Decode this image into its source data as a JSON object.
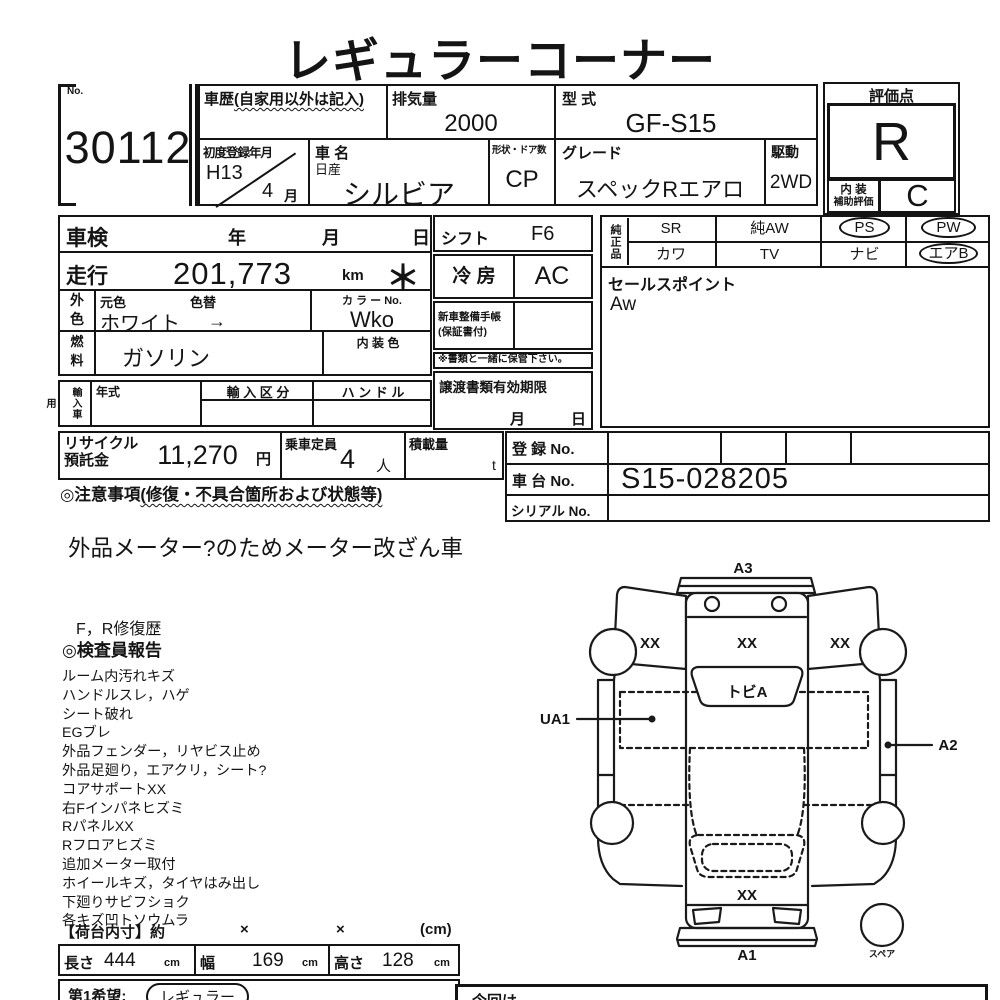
{
  "title": "レギュラーコーナー",
  "lot": {
    "no_label": "No.",
    "no": "30112"
  },
  "header": {
    "history": {
      "label": "車歴",
      "note": "(自家用以外は記入)"
    },
    "displacement": {
      "label": "排気量",
      "value": "2000"
    },
    "model_code": {
      "label": "型  式",
      "value": "GF-S15"
    },
    "first_reg": {
      "label": "初度登録年月",
      "year": "H13",
      "month": "4",
      "month_unit": "月"
    },
    "car_name": {
      "label": "車  名",
      "maker": "日産",
      "value": "シルビア"
    },
    "body_doors": {
      "label": "形状・ドア数",
      "value": "CP"
    },
    "grade": {
      "label": "グレード",
      "value": "スペックRエアロ"
    },
    "drive": {
      "label": "駆動",
      "value": "2WD"
    },
    "score": {
      "label": "評価点",
      "value": "R",
      "interior_label_1": "内 装",
      "interior_label_2": "補助評価",
      "interior_value": "C"
    }
  },
  "left_table": {
    "shaken": {
      "label": "車検",
      "year": "年",
      "month": "月",
      "day": "日"
    },
    "mileage": {
      "label": "走行",
      "value": "201,773",
      "unit": "km",
      "asterisk": "＊"
    },
    "color": {
      "header_1": "外",
      "header_2": "色",
      "base_label": "元色",
      "change_label": "色替",
      "value": "ホワイト",
      "arrow": "→",
      "color_no_label": "カ ラ ー No.",
      "color_no": "Wko"
    },
    "fuel": {
      "header_1": "燃",
      "header_2": "料",
      "value": "ガソリン",
      "interior_color_label": "内 装 色"
    },
    "import": {
      "header": "輸入車用",
      "year_label": "年式",
      "class_label": "輸 入 区 分",
      "handle_label": "ハ ン ド ル"
    }
  },
  "mid": {
    "shift": {
      "label": "シフト",
      "value": "F6"
    },
    "ac": {
      "label": "冷  房",
      "value": "AC"
    },
    "service_book": {
      "label": "新車整備手帳",
      "sub": "(保証書付)"
    },
    "keep_note": "※書類と一緒に保管下さい。",
    "transfer_docs": {
      "label": "譲渡書類有効期限",
      "month": "月",
      "day": "日"
    }
  },
  "oem": {
    "header": "純正品",
    "row1": [
      {
        "label": "SR",
        "circled": false
      },
      {
        "label": "純AW",
        "circled": false
      },
      {
        "label": "PS",
        "circled": true
      },
      {
        "label": "PW",
        "circled": true
      }
    ],
    "row2": [
      {
        "label": "カワ",
        "circled": false
      },
      {
        "label": "TV",
        "circled": false
      },
      {
        "label": "ナビ",
        "circled": false
      },
      {
        "label": "エアB",
        "circled": true
      }
    ]
  },
  "sales_point": {
    "label": "セールスポイント",
    "value": "Aw"
  },
  "recycle": {
    "label1": "リサイクル",
    "label2": "預託金",
    "value": "11,270",
    "unit": "円"
  },
  "capacity": {
    "label": "乗車定員",
    "value": "4",
    "unit": "人"
  },
  "load": {
    "label": "積載量",
    "unit": "t"
  },
  "registration": {
    "reg_label": "登  録  No.",
    "chassis_label": "車  台  No.",
    "chassis_value": "S15-028205",
    "serial_label": "シリアル No."
  },
  "caution": {
    "heading": "◎注意事項",
    "heading_note": "(修復・不具合箇所および状態等)",
    "note": "外品メーター?のためメーター改ざん車"
  },
  "inspector": {
    "repair_history": "F，R修復歴",
    "heading": "◎検査員報告",
    "remarks": [
      "ルーム内汚れキズ",
      "ハンドルスレ，ハゲ",
      "シート破れ",
      "EGブレ",
      "外品フェンダー，リヤビス止め",
      "外品足廻り，エアクリ，シート?",
      "コアサポートXX",
      "右Fインパネヒズミ",
      "RパネルXX",
      "Rフロアヒズミ",
      "追加メーター取付",
      "ホイールキズ，タイヤはみ出し",
      "下廻りサビフショク",
      "各キズ凹トソウムラ"
    ]
  },
  "cargo": {
    "heading": "【荷台内寸】約",
    "x1": "×",
    "x2": "×",
    "unit": "(cm)",
    "length_label": "長さ",
    "length": "444",
    "width_label": "幅",
    "width": "169",
    "height_label": "高さ",
    "height": "128",
    "cm": "cm"
  },
  "wish": {
    "label": "第1希望:",
    "value": "レギュラー"
  },
  "bottom_right_note": {
    "partial_text": "今回は"
  },
  "diagram": {
    "a3": "A3",
    "xx_left": "XX",
    "xx_roof": "XX",
    "xx_right": "XX",
    "rear_glass": "トビA",
    "ua1": "UA1",
    "a2": "A2",
    "xx_front": "XX",
    "a1": "A1",
    "spare": "スペア"
  }
}
